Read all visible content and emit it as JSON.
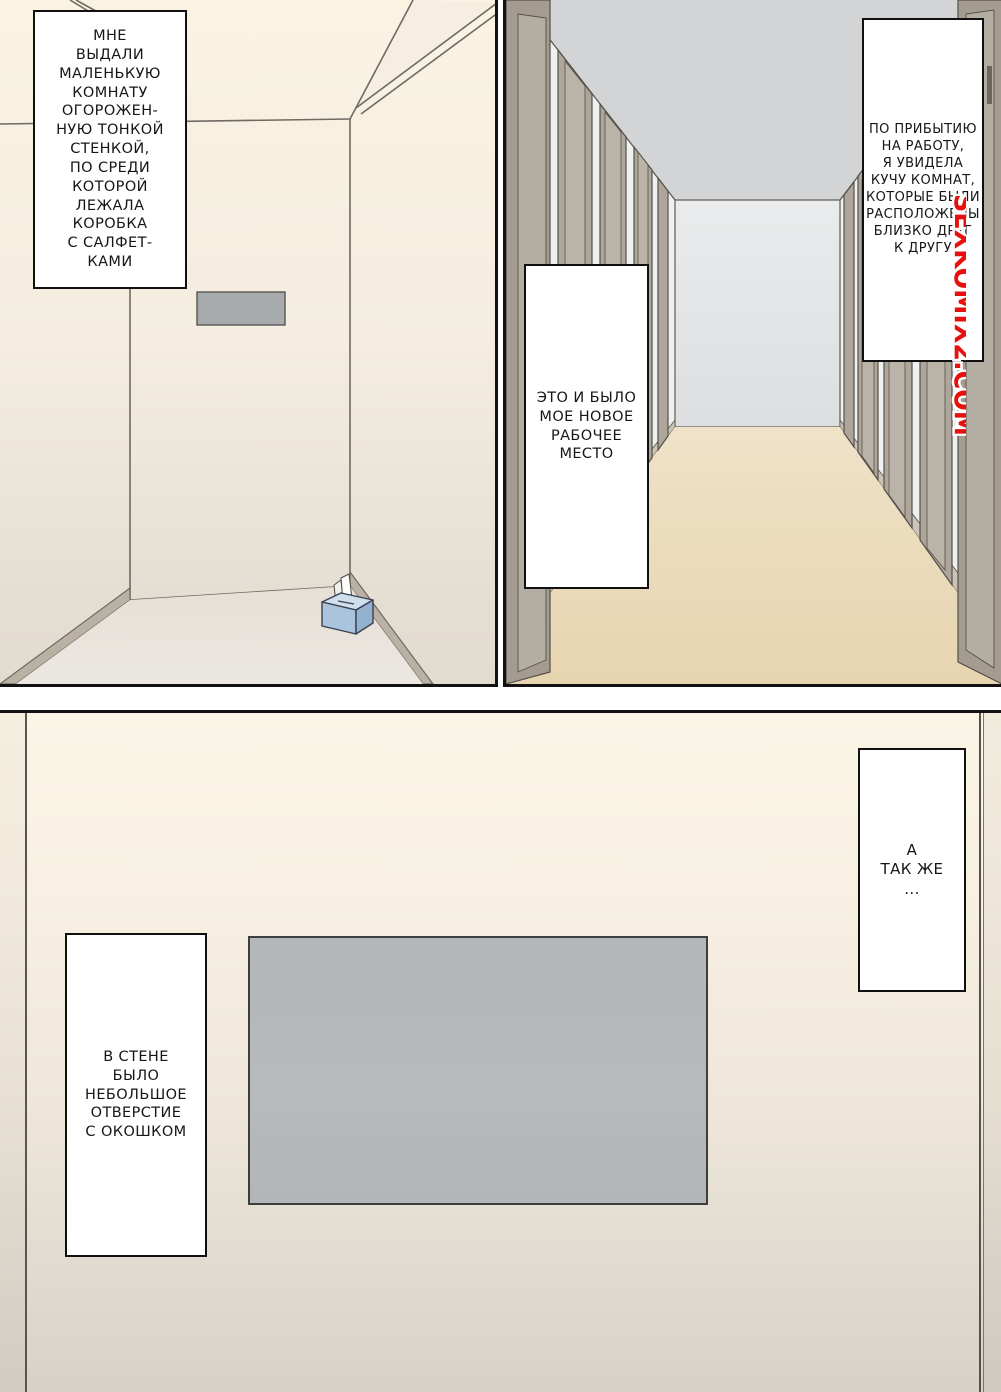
{
  "comic": {
    "watermark": {
      "text": "SEXKOMIX2.COM",
      "color": "#e8100c"
    },
    "panels": {
      "room": {
        "caption": "МНЕ\nВЫДАЛИ\nМАЛЕНЬКУЮ\nКОМНАТУ\nОГОРОЖЕН-\nНУЮ ТОНКОЙ\nСТЕНКОЙ,\nПО СРЕДИ\nКОТОРОЙ\nЛЕЖАЛА\nКОРОБКА\nС САЛФЕТ-\nКАМИ"
      },
      "hallway": {
        "caption_arrival": "ПО ПРИБЫТИЮ\nНА РАБОТУ,\nЯ УВИДЕЛА\nКУЧУ КОМНАТ,\nКОТОРЫЕ БЫЛИ\nРАСПОЛОЖЕНЫ\nБЛИЗКО ДРУГ\nК ДРУГУ",
        "caption_workplace": "ЭТО И БЫЛО\nМОЕ НОВОЕ\nРАБОЧЕЕ\nМЕСТО"
      },
      "wall_room": {
        "caption_also": "А\nТАК ЖЕ\n...",
        "caption_window": "В СТЕНЕ\nБЫЛО\nНЕБОЛЬШОЕ\nОТВЕРСТИЕ\nС ОКОШКОМ"
      }
    },
    "colors": {
      "panel_border": "#121212",
      "wall_cream": "#faf3e3",
      "wall_gray_bottom": "#d7d1c9",
      "ceiling_gray": "#d2d4d6",
      "hall_floor_beige": "#e9d7b6",
      "window_opening_gray": "#b5b9ba",
      "tissue_box_blue": "#aac4de",
      "watermark_red": "#e8100c"
    }
  }
}
